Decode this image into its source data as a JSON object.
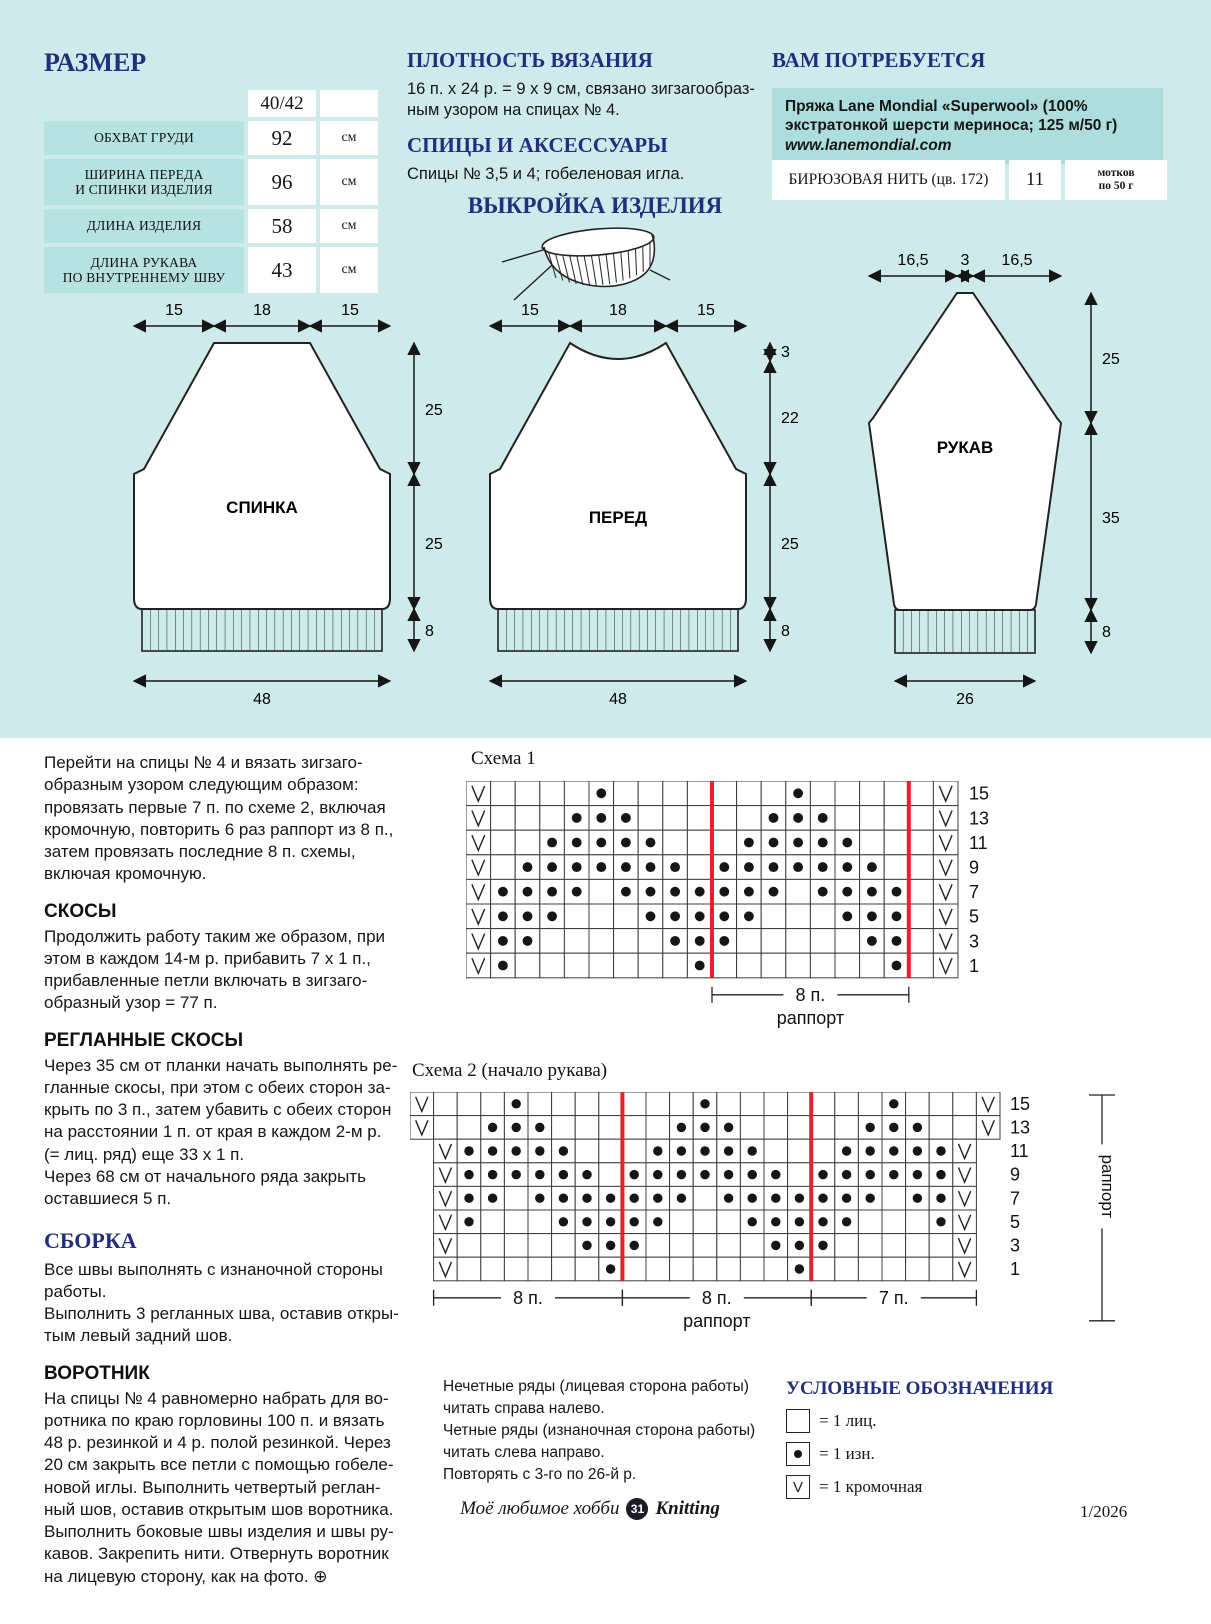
{
  "size_section": {
    "title": "РАЗМЕР",
    "table": {
      "size_header": "40/42",
      "rows": [
        {
          "label": "ОБХВАТ ГРУДИ",
          "value": "92",
          "unit": "см"
        },
        {
          "label": "ШИРИНА ПЕРЕДА\nИ СПИНКИ ИЗДЕЛИЯ",
          "value": "96",
          "unit": "см"
        },
        {
          "label": "ДЛИНА ИЗДЕЛИЯ",
          "value": "58",
          "unit": "см"
        },
        {
          "label": "ДЛИНА РУКАВА\nПО ВНУТРЕННЕМУ ШВУ",
          "value": "43",
          "unit": "см"
        }
      ]
    }
  },
  "gauge_section": {
    "title": "ПЛОТНОСТЬ ВЯЗАНИЯ",
    "text": "16 п. х 24 р. = 9 х 9 см, связано зигзагообраз-\nным узором на спицах № 4."
  },
  "needles_section": {
    "title": "СПИЦЫ И АКСЕССУАРЫ",
    "text": "Спицы № 3,5 и 4; гобеленовая игла."
  },
  "materials_section": {
    "title": "ВАМ ПОТРЕБУЕТСЯ",
    "yarn_line1": "Пряжа Lane Mondial «Superwool» (100%",
    "yarn_line2": "экстратонкой шерсти мериноса; 125 м/50 г)",
    "website": "www.lanemondial.com",
    "color_row": {
      "name": "БИРЮЗОВАЯ НИТЬ (цв. 172)",
      "count": "11",
      "unit": "мотков\nпо 50 г"
    }
  },
  "layout_title": "ВЫКРОЙКА ИЗДЕЛИЯ",
  "pieces": {
    "back": {
      "name": "СПИНКА",
      "top": [
        "15",
        "18",
        "15"
      ],
      "right": [
        "25",
        "25",
        "8"
      ],
      "bottom": "48"
    },
    "front": {
      "name": "ПЕРЕД",
      "top": [
        "15",
        "18",
        "15"
      ],
      "right": [
        "3",
        "22",
        "25",
        "8"
      ],
      "bottom": "48"
    },
    "sleeve": {
      "name": "РУКАВ",
      "top": [
        "16,5",
        "3",
        "16,5"
      ],
      "right": [
        "25",
        "35",
        "8"
      ],
      "bottom": "26"
    }
  },
  "instructions": [
    {
      "style": "p",
      "text": "Перейти на спицы № 4 и вязать зигзаго-\nобразным узором следующим образом:\nпровязать первые 7 п. по схеме 2, включая\nкромочную, повторить 6 раз раппорт из 8 п.,\nзатем провязать последние 8 п. схемы,\nвключая кромочную."
    },
    {
      "style": "h2",
      "text": "СКОСЫ"
    },
    {
      "style": "p",
      "text": "Продолжить работу таким же образом, при\nэтом в каждом 14-м р. прибавить 7 х 1 п.,\nприбавленные петли включать в зигзаго-\nобразный узор = 77 п."
    },
    {
      "style": "h2",
      "text": "РЕГЛАННЫЕ СКОСЫ"
    },
    {
      "style": "p",
      "text": "Через 35 см от планки начать выполнять ре-\nгланные скосы, при этом с обеих сторон за-\nкрыть по 3 п., затем убавить с обеих сторон\nна расстоянии 1 п. от края в каждом 2-м р.\n(= лиц. ряд) еще 33 х 1 п.\nЧерез 68 см от начального ряда закрыть\nоставшиеся 5 п."
    },
    {
      "style": "h1",
      "text": "СБОРКА"
    },
    {
      "style": "p",
      "text": "Все швы выполнять с изнаночной стороны\nработы.\nВыполнить 3 регланных шва, оставив откры-\nтым левый задний шов."
    },
    {
      "style": "h2",
      "text": "ВОРОТНИК"
    },
    {
      "style": "p",
      "text": "На спицы № 4 равномерно набрать для во-\nротника по краю горловины 100 п. и вязать\n48 р. резинкой и 4 р. полой резинкой. Через\n20 см закрыть все петли с помощью гобеле-\nновой иглы. Выполнить четвертый реглан-\nный шов, оставив открытым шов воротника.\nВыполнить боковые швы изделия и швы ру-\nкавов. Закрепить нити. Отвернуть воротник\nна лицевую сторону, как на фото. ⊕"
    }
  ],
  "chart_data": [
    {
      "type": "heatmap",
      "name": "chart1",
      "title": "Схема 1",
      "symbol_key": {
        "blank": "1 лиц.",
        "dot": "1 изн.",
        "v": "1 кромочная"
      },
      "rows": [
        {
          "num": "15",
          "dots": [
            5,
            13
          ]
        },
        {
          "num": "13",
          "dots": [
            4,
            5,
            6,
            12,
            13,
            14
          ]
        },
        {
          "num": "11",
          "dots": [
            3,
            4,
            5,
            6,
            7,
            11,
            12,
            13,
            14,
            15
          ]
        },
        {
          "num": "9",
          "dots": [
            2,
            3,
            4,
            5,
            6,
            7,
            8,
            10,
            11,
            12,
            13,
            14,
            15,
            16
          ]
        },
        {
          "num": "7",
          "dots": [
            1,
            2,
            3,
            4,
            6,
            7,
            8,
            9,
            10,
            11,
            12,
            14,
            15,
            16,
            17
          ]
        },
        {
          "num": "5",
          "dots": [
            1,
            2,
            3,
            7,
            8,
            9,
            10,
            11,
            15,
            16,
            17
          ]
        },
        {
          "num": "3",
          "dots": [
            1,
            2,
            8,
            9,
            10,
            16,
            17
          ]
        },
        {
          "num": "1",
          "dots": [
            1,
            9,
            17
          ]
        }
      ],
      "total_cols": 20,
      "red_boundaries": [
        10,
        18
      ],
      "brackets": [
        {
          "x1": 10,
          "x2": 18,
          "label": "8 п.",
          "sub": "раппорт"
        }
      ]
    },
    {
      "type": "heatmap",
      "name": "chart2",
      "title": "Схема 2 (начало рукава)",
      "rows": [
        {
          "num": "15",
          "ext": true,
          "dots": [
            4,
            12,
            20
          ]
        },
        {
          "num": "13",
          "ext": true,
          "dots": [
            3,
            4,
            5,
            11,
            12,
            13,
            19,
            20,
            21
          ]
        },
        {
          "num": "11",
          "dots": [
            2,
            3,
            4,
            5,
            6,
            10,
            11,
            12,
            13,
            14,
            18,
            19,
            20,
            21,
            22
          ]
        },
        {
          "num": "9",
          "dots": [
            2,
            3,
            4,
            5,
            6,
            7,
            9,
            10,
            11,
            12,
            13,
            14,
            15,
            17,
            18,
            19,
            20,
            21,
            22
          ]
        },
        {
          "num": "7",
          "dots": [
            2,
            3,
            5,
            6,
            7,
            8,
            9,
            10,
            11,
            13,
            14,
            15,
            16,
            17,
            18,
            19,
            21,
            22
          ]
        },
        {
          "num": "5",
          "dots": [
            2,
            6,
            7,
            8,
            9,
            10,
            14,
            15,
            16,
            17,
            18,
            22
          ]
        },
        {
          "num": "3",
          "dots": [
            7,
            8,
            9,
            15,
            16,
            17
          ]
        },
        {
          "num": "1",
          "dots": [
            8,
            16
          ]
        }
      ],
      "total_cols": 25,
      "red_boundaries": [
        9,
        17
      ],
      "brackets": [
        {
          "x1": 1,
          "x2": 9,
          "label": "8 п."
        },
        {
          "x1": 9,
          "x2": 17,
          "label": "8 п.",
          "sub": "раппорт"
        },
        {
          "x1": 17,
          "x2": 24,
          "label": "7 п."
        }
      ],
      "side_bracket": "раппорт"
    }
  ],
  "chart_notes": "Нечетные ряды (лицевая сторона работы)\nчитать справа налево.\nЧетные ряды (изнаночная сторона работы)\nчитать слева направо.\nПовторять с 3-го по 26-й р.",
  "legend": {
    "title": "УСЛОВНЫЕ ОБОЗНАЧЕНИЯ",
    "items": [
      {
        "symbol": "plain-square-icon",
        "text": "= 1 лиц."
      },
      {
        "symbol": "dot-square-icon",
        "text": "= 1 изн."
      },
      {
        "symbol": "v-square-icon",
        "text": "= 1 кромочная"
      }
    ]
  },
  "footer": {
    "magazine": "Моё любимое хобби",
    "page_number": "31",
    "brand": "Knitting",
    "issue": "1/2026"
  }
}
